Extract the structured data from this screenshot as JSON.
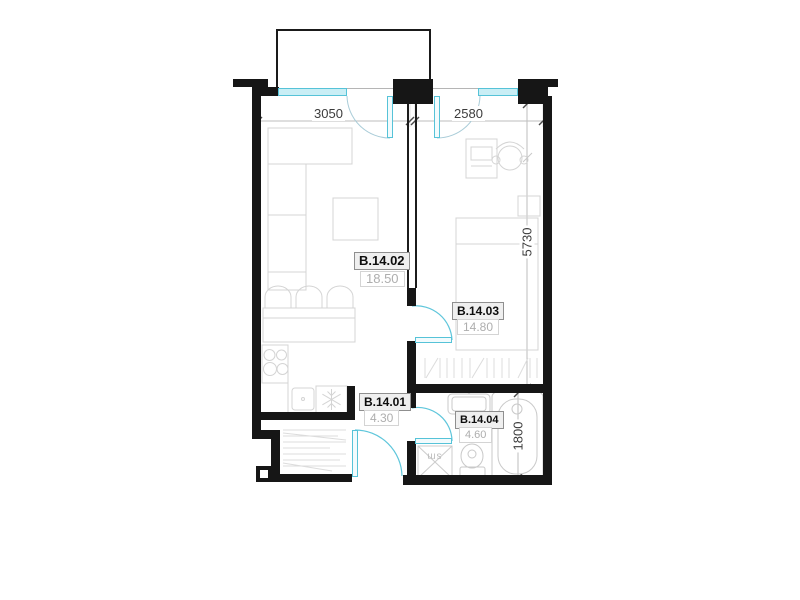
{
  "rooms": [
    {
      "code": "B.14.02",
      "area": "18.50"
    },
    {
      "code": "B.14.03",
      "area": "14.80"
    },
    {
      "code": "B.14.01",
      "area": "4.30"
    },
    {
      "code": "B.14.04",
      "area": "4.60"
    }
  ],
  "dimensions": {
    "living_width": "3050",
    "bedroom_width": "2580",
    "right_height": "5730",
    "bathroom_height": "1800"
  },
  "labels": {
    "shaft": "sm"
  },
  "colors": {
    "wall": "#161616",
    "window_fill": "#c9eef5",
    "door_stroke": "#5fc6db",
    "balcony_arc": "#a9ccd8",
    "furniture": "#d4d4d4",
    "dim_line": "#bdbdbd",
    "dim_text": "#3c3c3c",
    "area_text": "#aeaeae"
  }
}
